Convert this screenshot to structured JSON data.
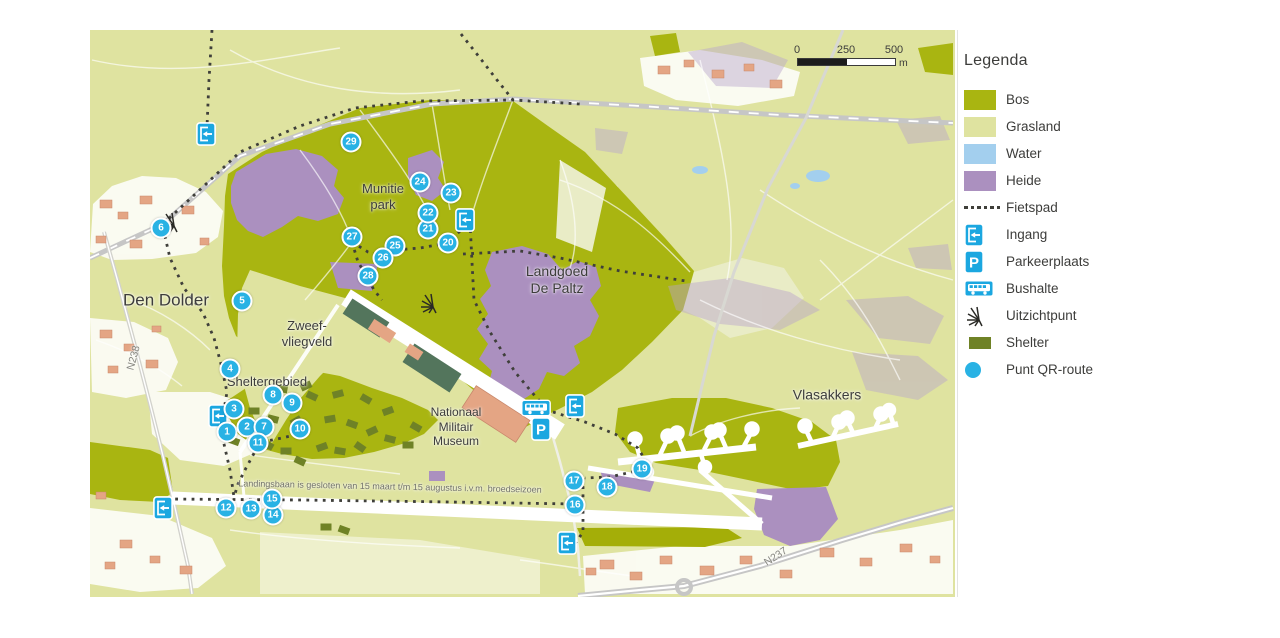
{
  "legend": {
    "title": "Legenda",
    "items": [
      {
        "id": "bos",
        "label": "Bos",
        "icon": "swatch",
        "color": "#a9b511"
      },
      {
        "id": "grasland",
        "label": "Grasland",
        "icon": "swatch",
        "color": "#dfe3a0"
      },
      {
        "id": "water",
        "label": "Water",
        "icon": "swatch",
        "color": "#a3cfee"
      },
      {
        "id": "heide",
        "label": "Heide",
        "icon": "swatch",
        "color": "#ab90bf"
      },
      {
        "id": "fietspad",
        "label": "Fietspad",
        "icon": "dots"
      },
      {
        "id": "ingang",
        "label": "Ingang",
        "icon": "ingang"
      },
      {
        "id": "parkeerplaats",
        "label": "Parkeerplaats",
        "icon": "parking"
      },
      {
        "id": "bushalte",
        "label": "Bushalte",
        "icon": "bus"
      },
      {
        "id": "uitzichtpunt",
        "label": "Uitzichtpunt",
        "icon": "viewpoint"
      },
      {
        "id": "shelter",
        "label": "Shelter",
        "icon": "shelter",
        "color": "#6f8226"
      },
      {
        "id": "punt-qr-route",
        "label": "Punt QR-route",
        "icon": "qr-point",
        "color": "#29b2e4"
      }
    ]
  },
  "scalebar": {
    "ticks": [
      "0",
      "250",
      "500"
    ],
    "unit": "m"
  },
  "map": {
    "labels": [
      {
        "id": "den-dolder",
        "lines": [
          "Den Dolder"
        ],
        "x": 166,
        "y": 301,
        "size": 17,
        "color": "#3d3d3b",
        "rot": 0
      },
      {
        "id": "n238",
        "lines": [
          "N238"
        ],
        "x": 134,
        "y": 358,
        "size": 10.5,
        "color": "#85857e",
        "rot": -75
      },
      {
        "id": "zweefvliegveld",
        "lines": [
          "Zweef-",
          "vliegveld"
        ],
        "x": 307,
        "y": 334,
        "size": 13,
        "color": "#3d3d3b",
        "rot": 0
      },
      {
        "id": "sheltergebied",
        "lines": [
          "Sheltergebied"
        ],
        "x": 267,
        "y": 382,
        "size": 13,
        "color": "#3d3d3b",
        "rot": 0
      },
      {
        "id": "munitiepark",
        "lines": [
          "Munitie",
          "park"
        ],
        "x": 383,
        "y": 197,
        "size": 13,
        "color": "#3d3d3b",
        "rot": 0
      },
      {
        "id": "landgoed-de-paltz",
        "lines": [
          "Landgoed",
          "De Paltz"
        ],
        "x": 557,
        "y": 280,
        "size": 14,
        "color": "#3d3d3b",
        "rot": 0
      },
      {
        "id": "nationaal-militair-museum",
        "lines": [
          "Nationaal",
          "Militair",
          "Museum"
        ],
        "x": 456,
        "y": 427,
        "size": 12,
        "color": "#3d3d3b",
        "rot": 0
      },
      {
        "id": "vlasakkers",
        "lines": [
          "Vlasakkers"
        ],
        "x": 827,
        "y": 395,
        "size": 14,
        "color": "#3d3d3b",
        "rot": 0
      },
      {
        "id": "n237",
        "lines": [
          "N237"
        ],
        "x": 776,
        "y": 557,
        "size": 10.5,
        "color": "#85857e",
        "rot": -33
      },
      {
        "id": "runway-closure-note",
        "lines": [
          "Landingsbaan is gesloten van 15 maart t/m 15 augustus i.v.m. broedseizoen"
        ],
        "x": 390,
        "y": 487,
        "size": 9,
        "color": "#72726a",
        "rot": 1.2
      }
    ],
    "qr_points": [
      {
        "n": "1",
        "x": 227,
        "y": 432
      },
      {
        "n": "2",
        "x": 247,
        "y": 427
      },
      {
        "n": "3",
        "x": 234,
        "y": 409
      },
      {
        "n": "4",
        "x": 230,
        "y": 369
      },
      {
        "n": "5",
        "x": 242,
        "y": 301
      },
      {
        "n": "6",
        "x": 161,
        "y": 228
      },
      {
        "n": "7",
        "x": 264,
        "y": 427
      },
      {
        "n": "8",
        "x": 273,
        "y": 395
      },
      {
        "n": "9",
        "x": 292,
        "y": 403
      },
      {
        "n": "10",
        "x": 300,
        "y": 429
      },
      {
        "n": "11",
        "x": 258,
        "y": 443
      },
      {
        "n": "12",
        "x": 226,
        "y": 508
      },
      {
        "n": "13",
        "x": 251,
        "y": 509
      },
      {
        "n": "14",
        "x": 273,
        "y": 515
      },
      {
        "n": "15",
        "x": 272,
        "y": 499
      },
      {
        "n": "16",
        "x": 575,
        "y": 505
      },
      {
        "n": "17",
        "x": 574,
        "y": 481
      },
      {
        "n": "18",
        "x": 607,
        "y": 487
      },
      {
        "n": "19",
        "x": 642,
        "y": 469
      },
      {
        "n": "20",
        "x": 448,
        "y": 243
      },
      {
        "n": "21",
        "x": 428,
        "y": 229
      },
      {
        "n": "22",
        "x": 428,
        "y": 213
      },
      {
        "n": "23",
        "x": 451,
        "y": 193
      },
      {
        "n": "24",
        "x": 420,
        "y": 182
      },
      {
        "n": "25",
        "x": 395,
        "y": 246
      },
      {
        "n": "26",
        "x": 383,
        "y": 258
      },
      {
        "n": "27",
        "x": 352,
        "y": 237
      },
      {
        "n": "28",
        "x": 368,
        "y": 276
      },
      {
        "n": "29",
        "x": 351,
        "y": 142
      }
    ],
    "entrances": [
      {
        "x": 206,
        "y": 134
      },
      {
        "x": 218,
        "y": 416
      },
      {
        "x": 465,
        "y": 220
      },
      {
        "x": 575,
        "y": 406
      },
      {
        "x": 163,
        "y": 508
      },
      {
        "x": 567,
        "y": 543
      }
    ],
    "parking": [
      {
        "x": 541,
        "y": 429
      }
    ],
    "bus_stops": [
      {
        "x": 536,
        "y": 408
      }
    ],
    "viewpoints": [
      {
        "x": 429,
        "y": 303
      },
      {
        "x": 170,
        "y": 222
      }
    ]
  },
  "colors": {
    "bos": "#a9b511",
    "grasland": "#dfe3a0",
    "water": "#a3cfee",
    "heide": "#ab90bf",
    "heide_light": "#c2afd4",
    "icon_blue": "#1ba7e0",
    "qr_blue": "#29b2e4",
    "shelter": "#6f8226",
    "label": "#3d3d3b"
  }
}
